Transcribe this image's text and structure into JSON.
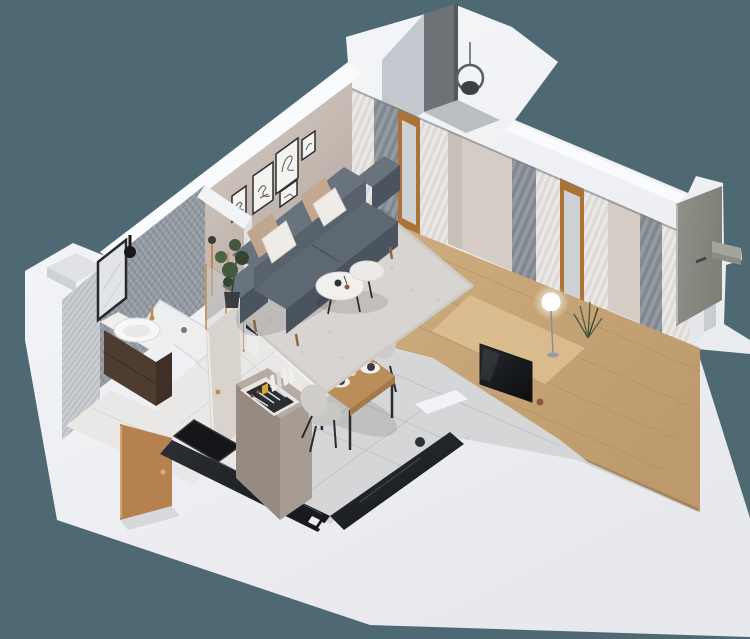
{
  "meta": {
    "scene": "isometric-3d-floor-plan-render-studio-apartment",
    "rooms": [
      {
        "name": "bathroom",
        "items": [
          "vanity-cabinet",
          "basin",
          "mirror",
          "wall-sconce",
          "shower-enclosure",
          "shower-tray",
          "towels",
          "mosaic-walls",
          "marble-floor"
        ]
      },
      {
        "name": "hallway",
        "items": [
          "entry-door",
          "bathroom-door",
          "marble-floor"
        ]
      },
      {
        "name": "kitchen",
        "items": [
          "black-marble-counter",
          "sink",
          "cooktop-burners",
          "tall-cabinet",
          "cutlery-tray",
          "books",
          "tile-floor"
        ]
      },
      {
        "name": "dining",
        "items": [
          "wood-table",
          "two-chairs",
          "place-settings",
          "vase"
        ]
      },
      {
        "name": "living-room",
        "items": [
          "gray-sofa",
          "pillows",
          "shag-rug",
          "coffee-table",
          "wall-art-frames",
          "floor-lamp",
          "tv",
          "plants",
          "wood-floor"
        ]
      },
      {
        "name": "balcony",
        "items": [
          "mesh-screen",
          "glass-panel",
          "hanging-chair"
        ]
      },
      {
        "name": "exterior",
        "items": [
          "open-olive-door",
          "door-shelf",
          "white-shell-walls"
        ]
      }
    ]
  },
  "colors": {
    "background": "#4e6973",
    "shellG1": "#f7f8fa",
    "shellG2": "#e7e9ed",
    "capWhite": "#fafbfd",
    "nicheShade": "#dfe1e6",
    "nicheDark": "#ced1d7",
    "balconyGlass": "#c3c9ce",
    "balconyMesh": "#6d7277",
    "balconyMeshDark": "#54585d",
    "balconyFloor": "#b9bec3",
    "chairFrame": "#5a5e63",
    "chairSeat": "#3c4146",
    "taupeLight": "#d8cdc6",
    "taupeDark": "#b3a8a0",
    "frameStroke": "#2e2e31",
    "frameMat": "#f5f3ef",
    "sketch": "#585a5e",
    "mosaic": "#a2a9b1",
    "mosaicDark": "#929aa3",
    "mosaicLine": "#3a4148",
    "tileWall": "#ced2d7",
    "mirrorGlass": "#e3e4e7",
    "mirrorFrame": "#27292c",
    "mirrorVein": "#cfd1d4",
    "black": "#17181b",
    "brass": "#c08a4f",
    "vanityWood": "#4e3c31",
    "vanityWoodDark": "#3f2f26",
    "vanityTop": "#efefed",
    "basin": "#f7f7f5",
    "basinInner": "#e9e9e7",
    "marbleFloor": "#eae8e6",
    "marbleSeam": "#d8d6d4",
    "trayWhite": "#edeeef",
    "trayEdge": "#d9dadc",
    "drain": "#77797c",
    "glassBlue": "#cdd4d8",
    "towelDark": "#26282c",
    "towelWhite": "#eceded",
    "partWhite": "#f2f3f6",
    "partShade": "#e0e2e7",
    "bathDoor": "#d9d3cd",
    "bathDoorEdge": "#efeae5",
    "woodG1": "#d2b285",
    "woodG2": "#bd9a6c",
    "plankLine": "#b08c60",
    "woodLight": "#ddbf92",
    "rug": "#d8d4d1",
    "rugEdge": "#cfcac6",
    "rugSpeckle": "#c5c0bc",
    "sofaLight": "#68737e",
    "sofaMid": "#57626d",
    "sofaSeat": "#5d6872",
    "sofaDark": "#4a545e",
    "sofaSeam": "#434d57",
    "legWood": "#8a6844",
    "pillowBeige": "#c0a68d",
    "pillowBeige2": "#c3a78e",
    "pillowWhite": "#efece7",
    "plantPot": "#3a3d3f",
    "plantGreen": "#44573f",
    "plantGreenDark": "#36452f",
    "plantGreenLight": "#4d6347",
    "tableTop": "#f2f0ed",
    "tableTop2": "#eceae6",
    "tableEdge": "#dcd9d5",
    "itemBowl": "#2e3032",
    "itemCup": "#8a5a3a",
    "tileFloor": "#d5d6d8",
    "tileGrout": "#c2c3c6",
    "counterDark1": "#2c2f34",
    "counterDark2": "#17191c",
    "counterVein": "#53565c",
    "sinkBlack": "#141619",
    "sinkEdge": "#33363b",
    "burner": "#0e0f11",
    "burnerRing": "#3c3f44",
    "cabinetTop": "#b6aba2",
    "cabinetFace": "#a79c93",
    "cabinetSide": "#968b82",
    "trayBorder": "#e8e6e3",
    "trayInner": "#2b2d30",
    "knife": "#d8d9db",
    "knifeHandle": "#8a5a2e",
    "book": "#f0efec",
    "bookShade": "#d9d8d4",
    "lemon": "#d9a43a",
    "dinWood": "#b98e58",
    "dinWoodEdge": "#a37a48",
    "chairShell": "#c9c7c3",
    "chairShell2": "#cfcdc9",
    "chairLeg": "#2a2c2e",
    "mat": "#f3f1ee",
    "plate": "#3a3c3e",
    "vase": "#e9e7e3",
    "curtainGrayA": "#7d828a",
    "curtainGrayB": "#9aa0a7",
    "sheerA": "#efedea",
    "sheerB": "#d8d5d2",
    "windowWood": "#ad7335",
    "windowGlass": "#ccd2d5",
    "pierWall": "#d5ccc6",
    "pierWall2": "#c8bfb9",
    "railDark": "#7c8084",
    "baseboard": "#f0f1f3",
    "endWall": "#e4e6ea",
    "doorway": "#c9ccd1",
    "olive1": "#90918a",
    "olive2": "#7f8078",
    "oliveEdge": "#b8b9b2",
    "shelfTop": "#a3a49b",
    "shelfFront": "#8b8c83",
    "handleDark": "#43454a",
    "tvDark1": "#26292e",
    "tvDark2": "#0e1012",
    "lampStem": "#8b8e92",
    "lampBase": "#9a9da0",
    "white": "#ffffff",
    "shadow": "#000000",
    "aoLine": "#9aa0a4",
    "doorWoodEntry": "#b5824f",
    "doorWoodLight": "#d3a86e",
    "doorHandle": "#d7b27c"
  }
}
